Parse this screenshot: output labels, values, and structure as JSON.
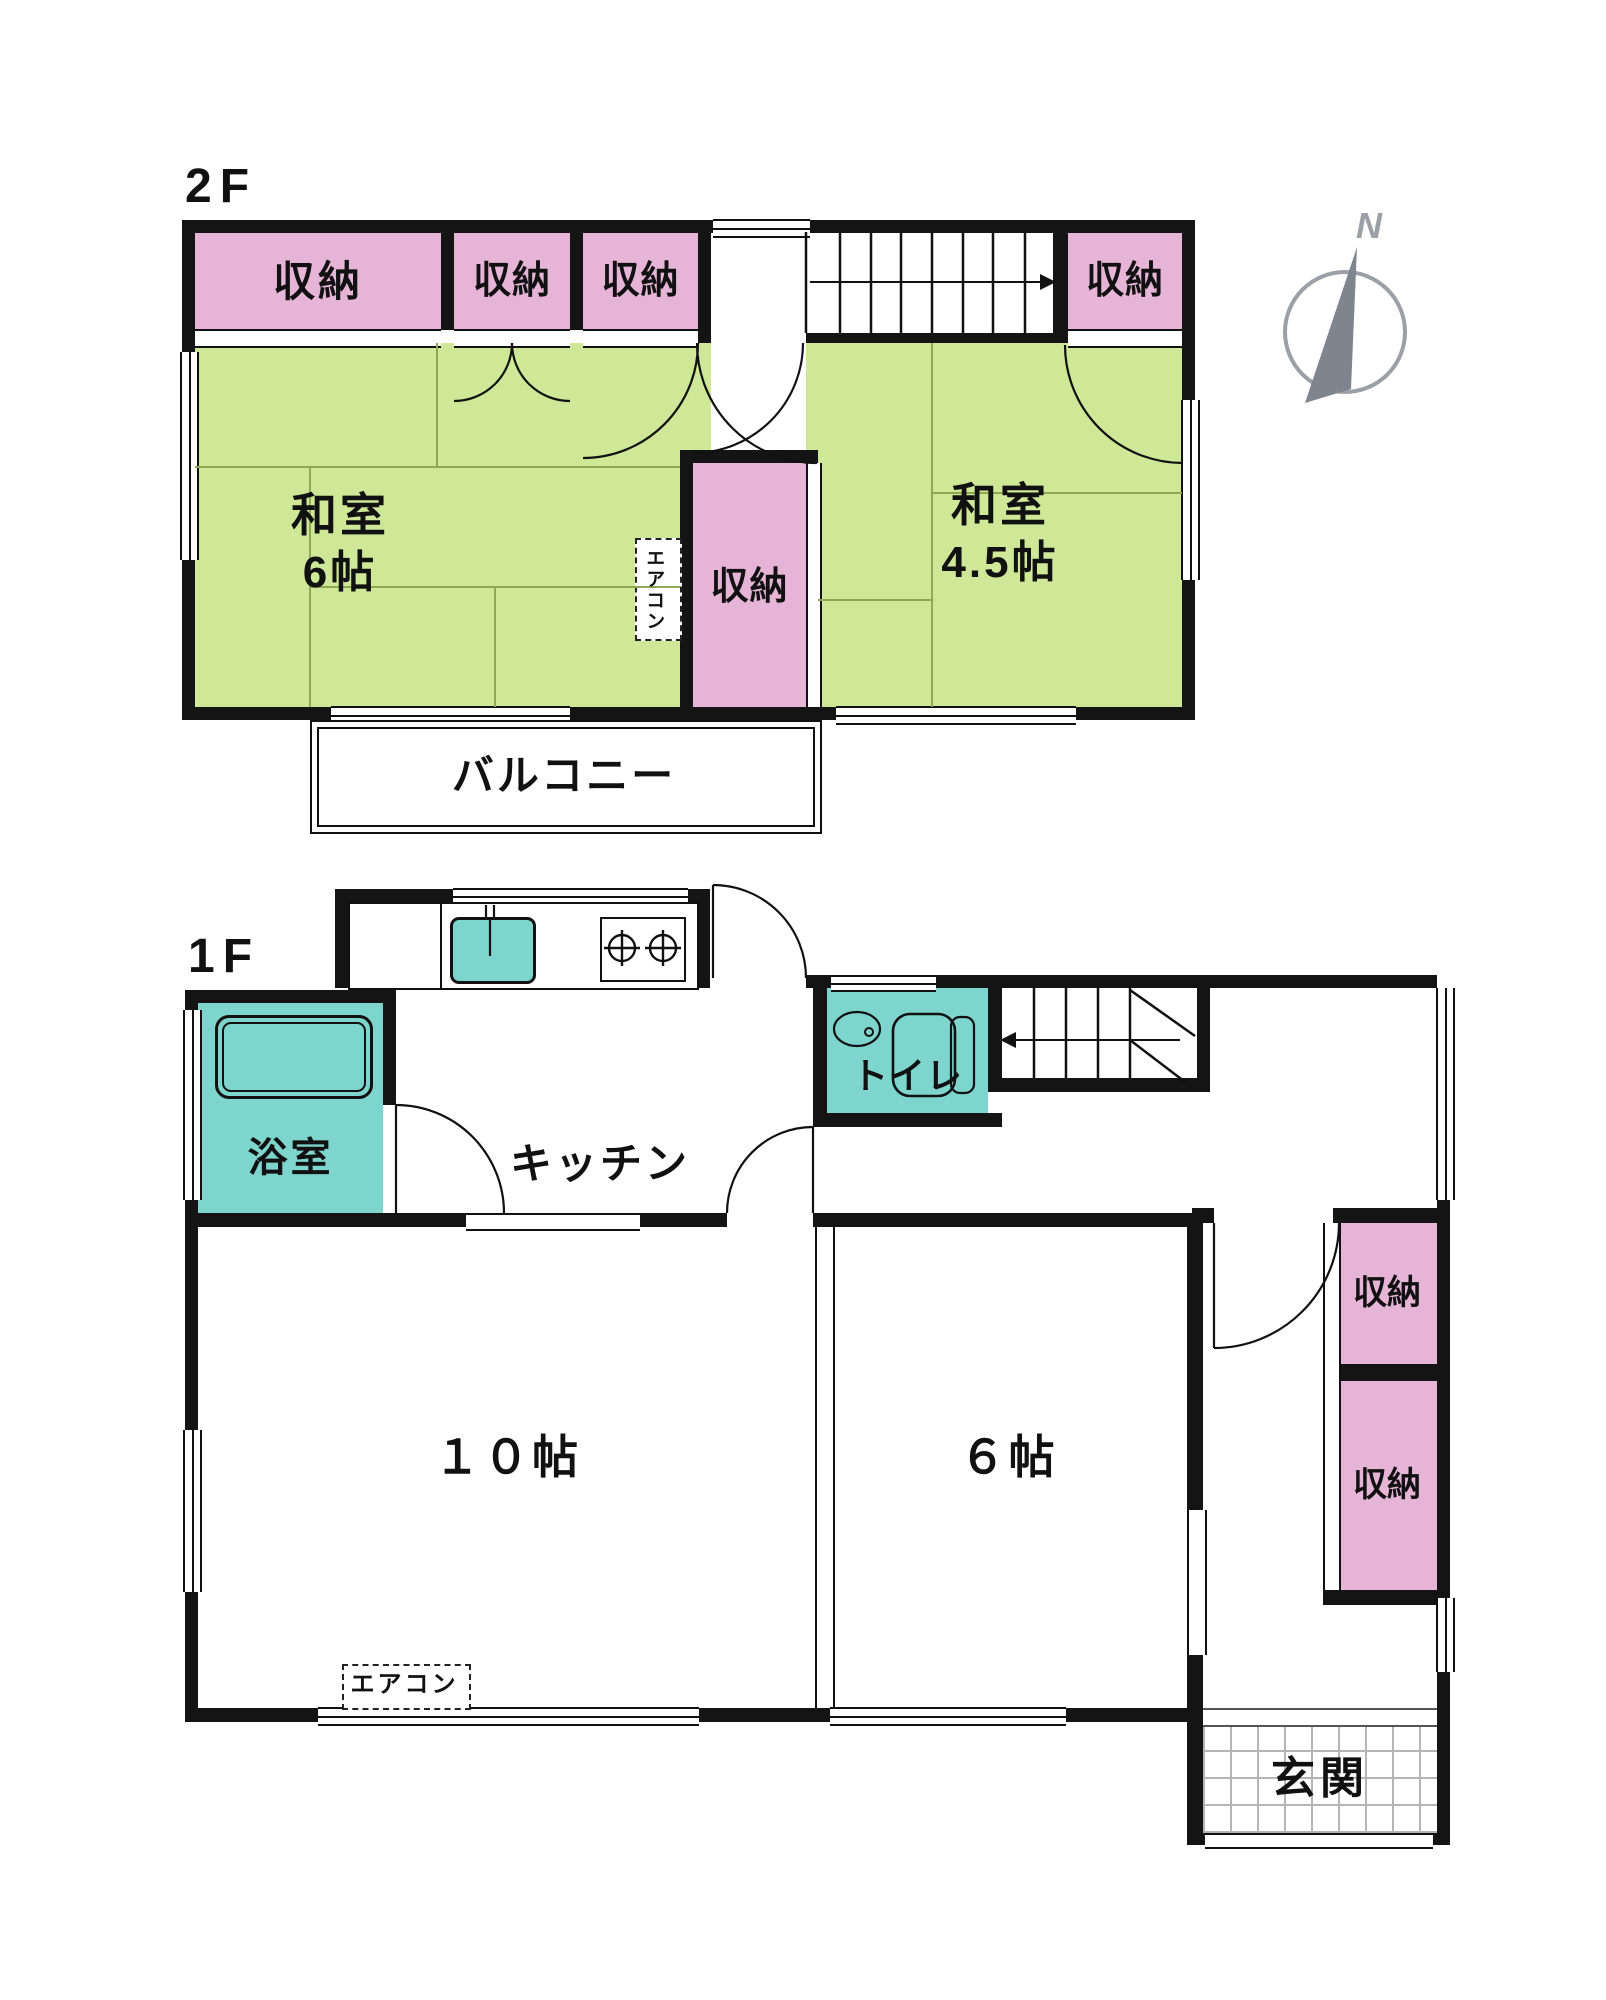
{
  "floor2": {
    "label": "2F",
    "rooms": [
      {
        "id": "closet-top-left",
        "label": "収納"
      },
      {
        "id": "closet-top-mid1",
        "label": "収納"
      },
      {
        "id": "closet-top-mid2",
        "label": "収納"
      },
      {
        "id": "closet-top-right",
        "label": "収納"
      },
      {
        "id": "washitsu-6",
        "label": "和室",
        "size": "6帖"
      },
      {
        "id": "closet-center",
        "label": "収納"
      },
      {
        "id": "washitsu-45",
        "label": "和室",
        "size": "4.5帖"
      },
      {
        "id": "balcony",
        "label": "バルコニー"
      }
    ],
    "aircon": "エアコン"
  },
  "floor1": {
    "label": "1F",
    "rooms": [
      {
        "id": "bathroom",
        "label": "浴室"
      },
      {
        "id": "kitchen",
        "label": "キッチン"
      },
      {
        "id": "toilet",
        "label": "トイレ"
      },
      {
        "id": "living-10",
        "label": "１０帖"
      },
      {
        "id": "room-6",
        "label": "６帖"
      },
      {
        "id": "closet-east-upper",
        "label": "収納"
      },
      {
        "id": "closet-east-lower",
        "label": "収納"
      },
      {
        "id": "entrance",
        "label": "玄関"
      }
    ],
    "aircon": "エアコン"
  },
  "compass": {
    "north": "N"
  },
  "colors": {
    "wall": "#141414",
    "tatami_green": "#cfe897",
    "closet_pink": "#e6b4d7",
    "water_teal": "#7ed5cd",
    "tile_line": "#b5b5b5",
    "compass_gray": "#9aa0a6",
    "tatami_line": "#8fa854"
  }
}
